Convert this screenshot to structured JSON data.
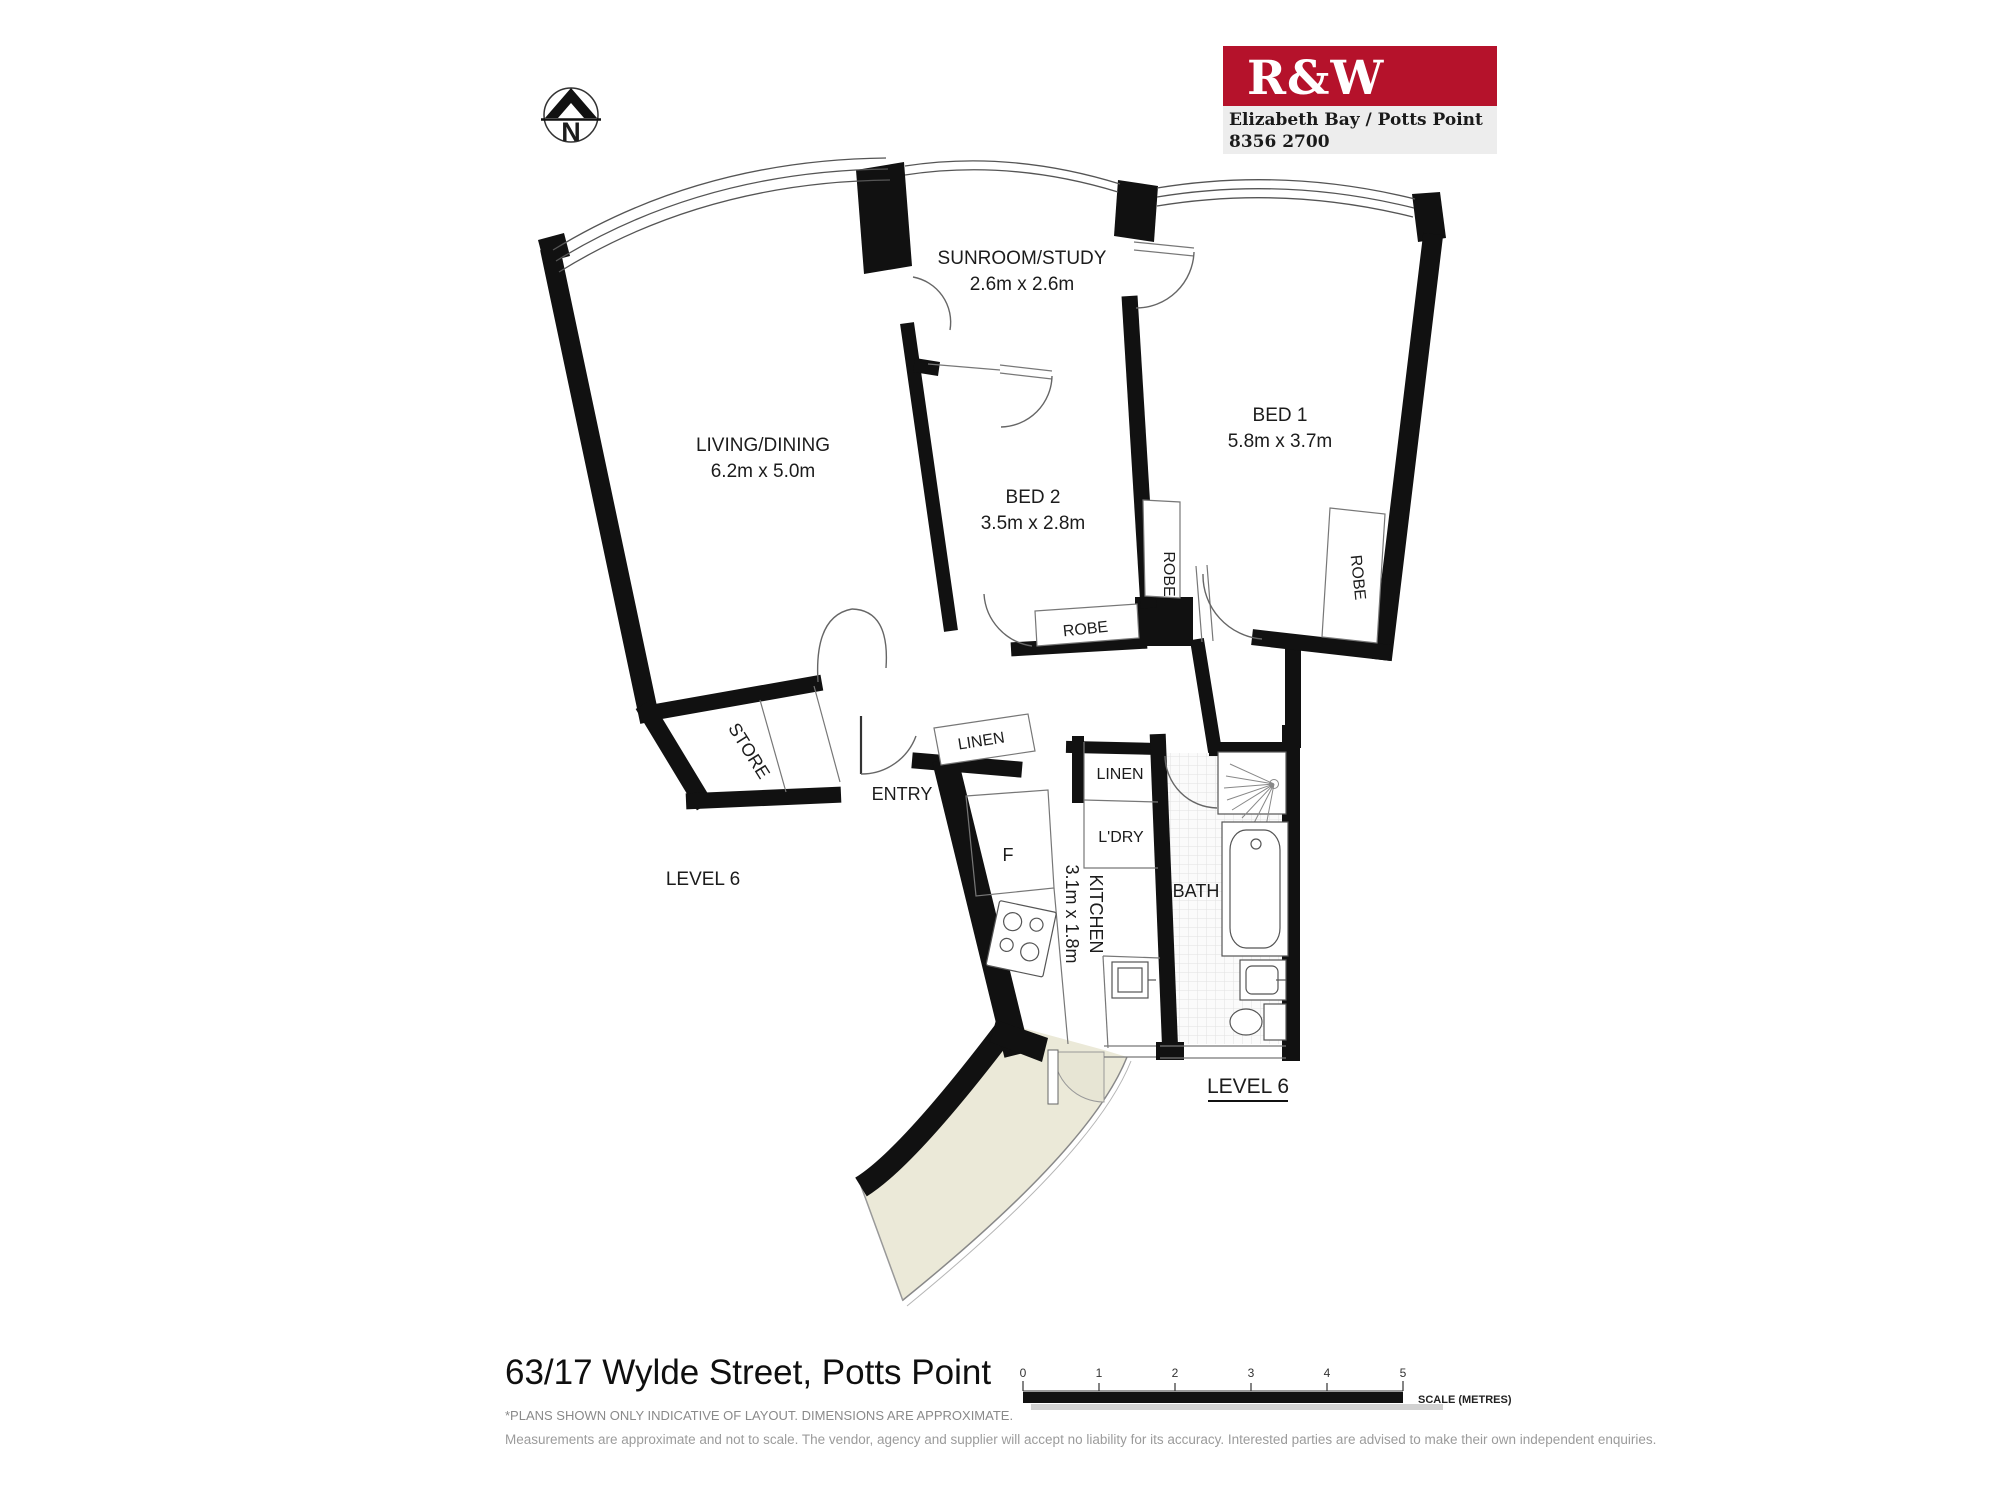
{
  "branding": {
    "logo": "R&W",
    "office": "Elizabeth Bay / Potts Point",
    "phone": "8356 2700",
    "brand_red": "#b5122b"
  },
  "compass": {
    "label": "N"
  },
  "plan": {
    "living": {
      "name": "LIVING/DINING",
      "dims": "6.2m x 5.0m"
    },
    "sunroom": {
      "name": "SUNROOM/STUDY",
      "dims": "2.6m x 2.6m"
    },
    "bed1": {
      "name": "BED 1",
      "dims": "5.8m x 3.7m"
    },
    "bed2": {
      "name": "BED 2",
      "dims": "3.5m x 2.8m"
    },
    "kitchen": {
      "name": "KITCHEN",
      "dims": "3.1m x 1.8m"
    },
    "bath": "BATH",
    "entry": "ENTRY",
    "store": "STORE",
    "laundry": "L'DRY",
    "linen_hall": "LINEN",
    "linen_kitchen": "LINEN",
    "robe_bed2_wall": "ROBE",
    "robe_hall": "ROBE",
    "robe_bed1": "ROBE",
    "fridge": "F",
    "level_left": "LEVEL 6",
    "level_right": "LEVEL 6"
  },
  "footer": {
    "address": "63/17 Wylde Street, Potts Point",
    "note1": "*PLANS SHOWN ONLY INDICATIVE OF LAYOUT. DIMENSIONS ARE APPROXIMATE.",
    "note2": "Measurements are approximate and not to scale. The vendor, agency and supplier will accept no liability for its accuracy. Interested parties are advised to make their own independent enquiries.",
    "scale": {
      "ticks": [
        "0",
        "1",
        "2",
        "3",
        "4",
        "5"
      ],
      "caption": "SCALE (METRES)"
    }
  }
}
